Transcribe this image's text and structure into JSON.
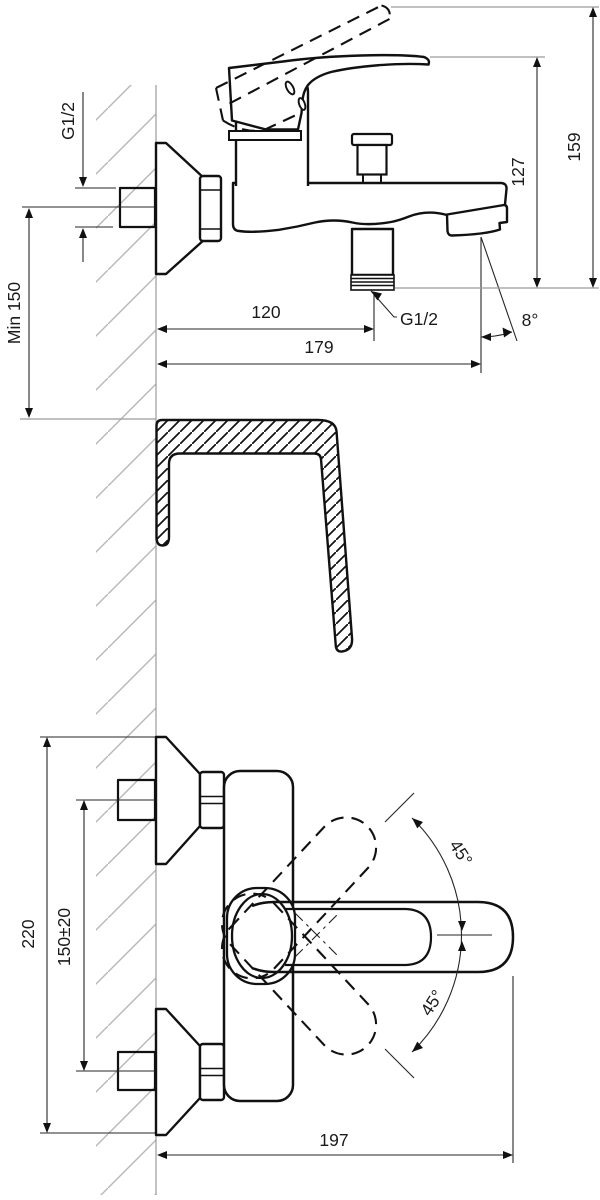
{
  "drawing": {
    "side_view": {
      "inlet_thread": "G1/2",
      "min_mounting_height": "Min 150",
      "outlet_offset": "120",
      "spout_reach": "179",
      "outlet_thread": "G1/2",
      "spout_angle": "8°",
      "body_height": "127",
      "total_height": "159"
    },
    "front_view": {
      "overall_height": "220",
      "inlet_spacing": "150±20",
      "handle_swing_up": "45°",
      "handle_swing_down": "45°",
      "overall_width": "197"
    },
    "colors": {
      "outline": "#111111",
      "dimension": "#262626",
      "reference": "#9b9b9b",
      "hatch": "#b8b8b8",
      "background": "#ffffff"
    }
  }
}
